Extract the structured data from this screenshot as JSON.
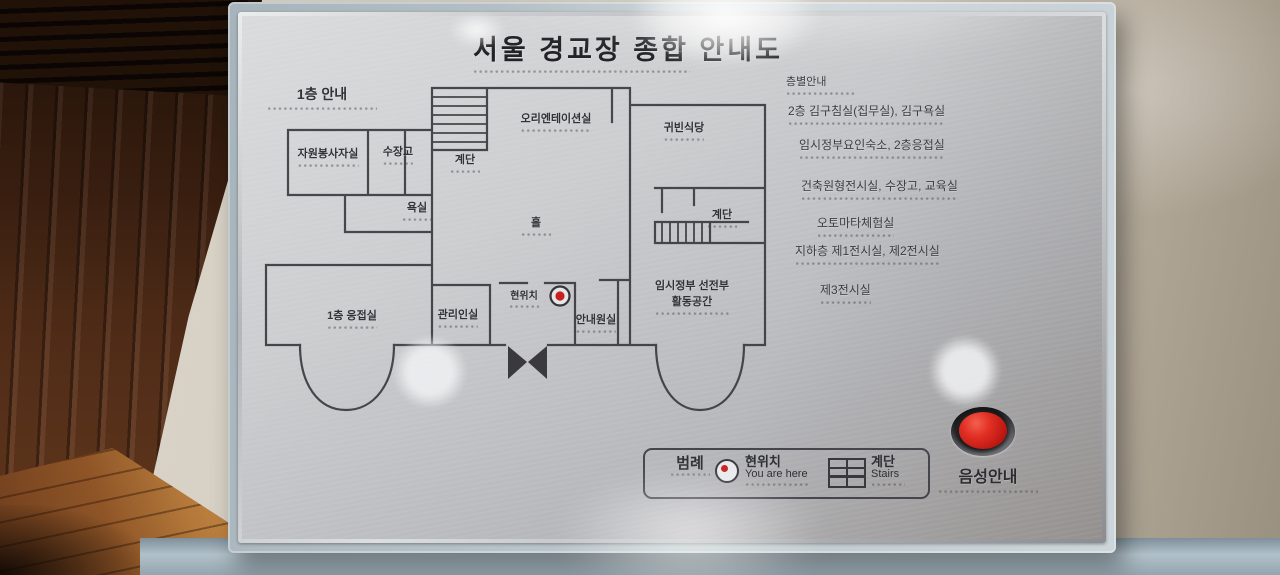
{
  "sign_title": "서울 경교장 종합 안내도",
  "floor_plan": {
    "heading": "1층 안내",
    "room_labels": [
      "오리엔테이션실",
      "귀빈식당",
      "자원봉사자실",
      "수장고",
      "계단",
      "욕실",
      "홀",
      "계단",
      "현위치",
      "임시정부 선전부",
      "활동공간",
      "1층 응접실",
      "관리인실",
      "안내원실"
    ]
  },
  "floor_directory": {
    "heading": "층별안내",
    "lines": [
      "2층 김구침실(집무실), 김구욕실",
      "임시정부요인숙소, 2층응접실",
      "건축원형전시실, 수장고, 교육실",
      "오토마타체험실",
      "지하층 제1전시실, 제2전시실",
      "제3전시실"
    ]
  },
  "legend": {
    "heading": "범례",
    "current_location_ko": "현위치",
    "current_location_en": "You are here",
    "stairs_ko": "계단",
    "stairs_en": "Stairs"
  },
  "audio_guide_label": "음성안내",
  "colors": {
    "plate_silver": "#c4c5c7",
    "frame_blue_gray": "#b8c4c9",
    "wall_line": "#3b3b3f",
    "marker_red": "#c8201f",
    "button_red": "#d42a22"
  }
}
